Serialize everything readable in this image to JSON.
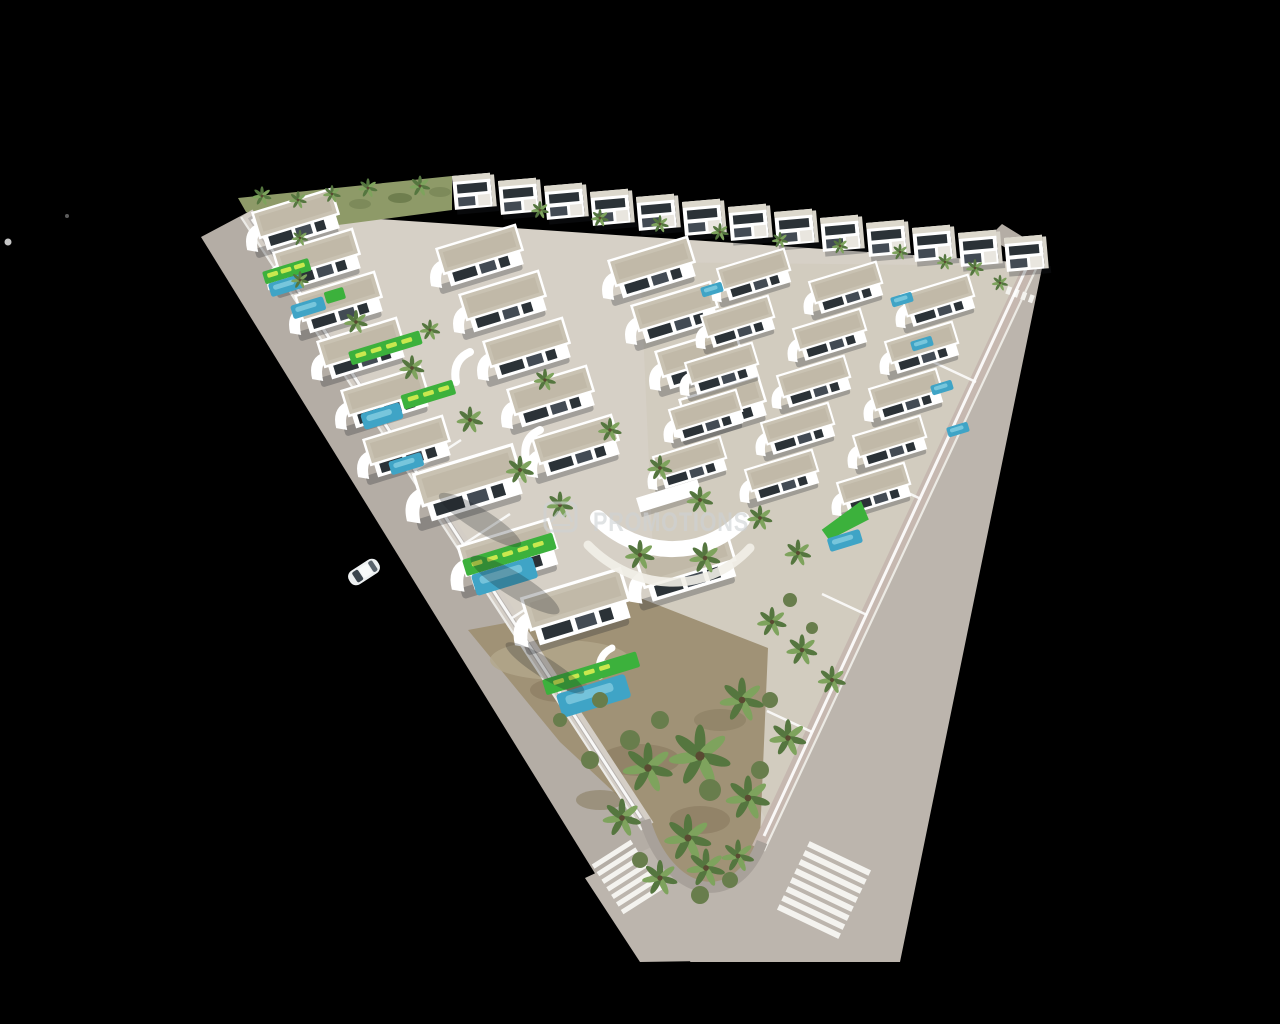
{
  "image": {
    "kind": "3d-aerial-architectural-render",
    "subject": "triangular villa resort development with pools, lawns, palm trees and perimeter roads on black background"
  },
  "watermark": {
    "text": "PROMOTIONS",
    "logo": "house-logo-icon",
    "color": "#ced2d4"
  },
  "objects": {
    "car_count": 1,
    "bird_count": 2,
    "crosswalk_count": 2
  },
  "palette": {
    "road": "#b4ada5",
    "road_light": "#bcb5ad",
    "sidewalk": "#d4cec6",
    "curb_pink": "#c6b8b0",
    "curb_wall": "#a8a19a",
    "ground": "#d6d0c6",
    "ground_right": "#d0c8ba",
    "garden": "#a09276",
    "wall": "#ffffff",
    "roof": "#c9c2b2",
    "roof_dark": "#bab2a0",
    "window": "#2b3237",
    "window_light": "#434b54",
    "pool": "#3fa4c6",
    "pool_light": "#90d4e6",
    "lawn": "#3cb13c",
    "lounger": "#c9e84e",
    "palm": "#55763f",
    "palm_light": "#7ea35d",
    "shrub": "#687d4c",
    "crosswalk": "#f4f3ef",
    "car_body": "#eef1f2",
    "watermark": "#ced2d4"
  }
}
